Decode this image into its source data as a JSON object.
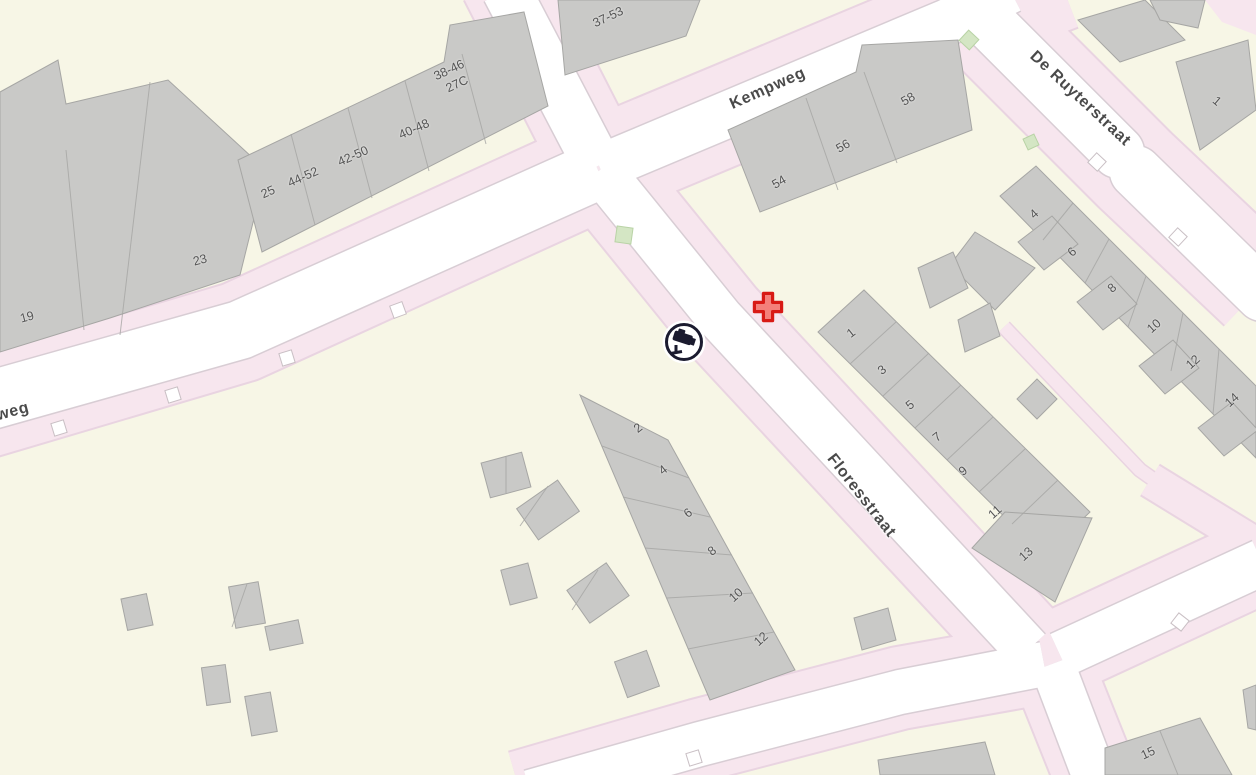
{
  "map": {
    "kind": "street-map",
    "colors": {
      "land": "#f7f6e6",
      "sidewalk_pink": "#f7e6ee",
      "road_white": "#ffffff",
      "building_gray": "#c9c9c7",
      "building_stroke": "#a6a6a4",
      "green_patch": "#d4e6c4",
      "label_text": "#4a4a4a",
      "cross_red": "#d81a15",
      "camera_dark": "#1b1b2f"
    },
    "street_labels": [
      {
        "text": "Kempweg",
        "x": 768,
        "y": 89,
        "rot": -24
      },
      {
        "text": "De Ruyterstraat",
        "x": 1080,
        "y": 99,
        "rot": 43
      },
      {
        "text": "Floresstraat",
        "x": 861,
        "y": 496,
        "rot": 52
      },
      {
        "text": "weg",
        "x": 13,
        "y": 412,
        "rot": -15
      }
    ],
    "house_numbers": [
      {
        "text": "37-53",
        "x": 608,
        "y": 17,
        "rot": -25
      },
      {
        "text": "38-46",
        "x": 449,
        "y": 70,
        "rot": -25
      },
      {
        "text": "27C",
        "x": 457,
        "y": 84,
        "rot": -25
      },
      {
        "text": "40-48",
        "x": 414,
        "y": 129,
        "rot": -24
      },
      {
        "text": "42-50",
        "x": 353,
        "y": 156,
        "rot": -24
      },
      {
        "text": "44-52",
        "x": 303,
        "y": 177,
        "rot": -24
      },
      {
        "text": "25",
        "x": 268,
        "y": 192,
        "rot": -24
      },
      {
        "text": "23",
        "x": 200,
        "y": 260,
        "rot": -15
      },
      {
        "text": "19",
        "x": 27,
        "y": 317,
        "rot": -15
      },
      {
        "text": "54",
        "x": 779,
        "y": 182,
        "rot": -30
      },
      {
        "text": "56",
        "x": 843,
        "y": 146,
        "rot": -30
      },
      {
        "text": "58",
        "x": 908,
        "y": 99,
        "rot": -30
      },
      {
        "text": "1",
        "x": 1217,
        "y": 101,
        "rot": 40
      },
      {
        "text": "1",
        "x": 851,
        "y": 333,
        "rot": -38
      },
      {
        "text": "3",
        "x": 882,
        "y": 370,
        "rot": -38
      },
      {
        "text": "5",
        "x": 910,
        "y": 405,
        "rot": -38
      },
      {
        "text": "7",
        "x": 937,
        "y": 437,
        "rot": -38
      },
      {
        "text": "9",
        "x": 963,
        "y": 471,
        "rot": -38
      },
      {
        "text": "11",
        "x": 995,
        "y": 512,
        "rot": -42
      },
      {
        "text": "13",
        "x": 1026,
        "y": 554,
        "rot": -42
      },
      {
        "text": "2",
        "x": 638,
        "y": 428,
        "rot": -38
      },
      {
        "text": "4",
        "x": 663,
        "y": 470,
        "rot": -38
      },
      {
        "text": "6",
        "x": 688,
        "y": 513,
        "rot": -38
      },
      {
        "text": "8",
        "x": 712,
        "y": 551,
        "rot": -38
      },
      {
        "text": "10",
        "x": 736,
        "y": 595,
        "rot": -42
      },
      {
        "text": "12",
        "x": 761,
        "y": 639,
        "rot": -42
      },
      {
        "text": "4",
        "x": 1034,
        "y": 214,
        "rot": -42
      },
      {
        "text": "6",
        "x": 1072,
        "y": 252,
        "rot": -42
      },
      {
        "text": "8",
        "x": 1112,
        "y": 288,
        "rot": -42
      },
      {
        "text": "10",
        "x": 1154,
        "y": 326,
        "rot": -42
      },
      {
        "text": "12",
        "x": 1193,
        "y": 362,
        "rot": -42
      },
      {
        "text": "14",
        "x": 1232,
        "y": 400,
        "rot": -42
      },
      {
        "text": "15",
        "x": 1148,
        "y": 753,
        "rot": -25
      }
    ],
    "markers": {
      "camera": {
        "x": 684,
        "y": 342,
        "label": "surveillance-camera"
      },
      "cross": {
        "x": 768,
        "y": 307,
        "label": "red-cross-location"
      }
    }
  }
}
